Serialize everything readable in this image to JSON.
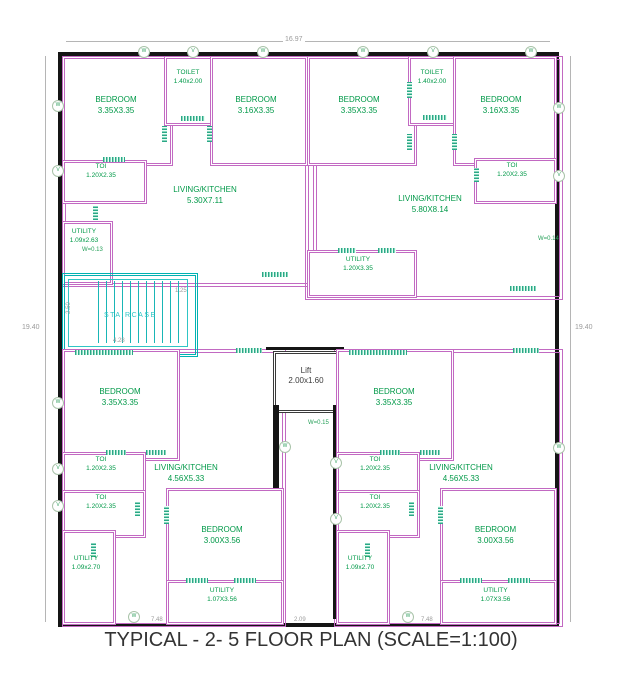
{
  "title": "TYPICAL - 2- 5 FLOOR PLAN (SCALE=1:100)",
  "colors": {
    "wall": "#C269C2",
    "outer_wall": "#151515",
    "room_label": "#009948",
    "staircase": "#00B2B2",
    "dimension": "#9B9B9B"
  },
  "dims": {
    "top": "16.97",
    "left": "19.40",
    "right": "19.40",
    "bottom_left": "7.48",
    "bottom_center": "2.09",
    "bottom_right": "7.48",
    "stair_width": "1.25",
    "stair_depth": "2.50",
    "stair_length": "4.28"
  },
  "rooms": {
    "tl_bed1": {
      "name": "BEDROOM",
      "size": "3.35X3.35"
    },
    "tl_toilet": {
      "name": "TOILET",
      "size": "1.40x2.00"
    },
    "tl_bed2": {
      "name": "BEDROOM",
      "size": "3.16X3.35"
    },
    "tl_toi": {
      "name": "TOI",
      "size": "1.20X2.35"
    },
    "tl_living": {
      "name": "LIVING/KITCHEN",
      "size": "5.30X7.11"
    },
    "tl_utility": {
      "name": "UTILITY",
      "size": "1.09x2.63"
    },
    "tr_bed1": {
      "name": "BEDROOM",
      "size": "3.35X3.35"
    },
    "tr_toilet": {
      "name": "TOILET",
      "size": "1.40x2.00"
    },
    "tr_bed2": {
      "name": "BEDROOM",
      "size": "3.16X3.35"
    },
    "tr_toi": {
      "name": "TOI",
      "size": "1.20X2.35"
    },
    "tr_living": {
      "name": "LIVING/KITCHEN",
      "size": "5.80X8.14"
    },
    "tr_utility": {
      "name": "UTILITY",
      "size": "1.20X3.35"
    },
    "staircase": {
      "name": "STAIRCASE"
    },
    "lift": {
      "name": "Lift",
      "size": "2.00x1.60"
    },
    "bl_bed1": {
      "name": "BEDROOM",
      "size": "3.35X3.35"
    },
    "bl_toi1": {
      "name": "TOI",
      "size": "1.20X2.35"
    },
    "bl_toi2": {
      "name": "TOI",
      "size": "1.20X2.35"
    },
    "bl_living": {
      "name": "LIVING/KITCHEN",
      "size": "4.56X5.33"
    },
    "bl_utility1": {
      "name": "UTILITY",
      "size": "1.09x2.70"
    },
    "bl_bed2": {
      "name": "BEDROOM",
      "size": "3.00X3.56"
    },
    "bl_utility2": {
      "name": "UTILITY",
      "size": "1.07X3.56"
    },
    "br_bed1": {
      "name": "BEDROOM",
      "size": "3.35X3.35"
    },
    "br_toi1": {
      "name": "TOI",
      "size": "1.20X2.35"
    },
    "br_toi2": {
      "name": "TOI",
      "size": "1.20X2.35"
    },
    "br_living": {
      "name": "LIVING/KITCHEN",
      "size": "4.56X5.33"
    },
    "br_utility1": {
      "name": "UTILITY",
      "size": "1.09x2.70"
    },
    "br_bed2": {
      "name": "BEDROOM",
      "size": "3.00X3.56"
    },
    "br_utility2": {
      "name": "UTILITY",
      "size": "1.07X3.56"
    }
  },
  "annotations": {
    "utility_wall": "W=0.13",
    "right_wall": "W=0.14",
    "lift_wall": "W=0.15"
  },
  "markers": [
    "W",
    "V",
    "W",
    "W",
    "V",
    "W",
    "W",
    "V",
    "W",
    "V",
    "V",
    "W",
    "V",
    "W",
    "W",
    "V",
    "V",
    "W",
    "W"
  ]
}
